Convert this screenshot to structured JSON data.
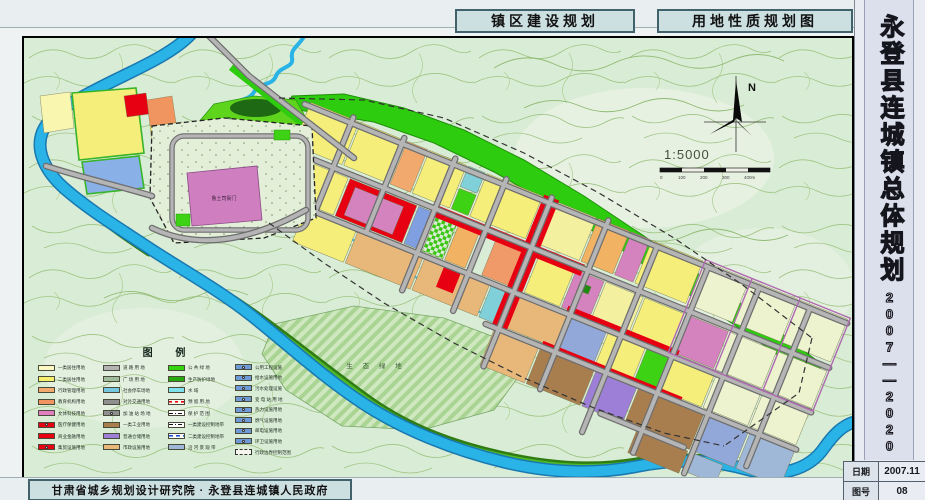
{
  "header": {
    "title_left": "镇区建设规划",
    "title_right": "用地性质规划图"
  },
  "sidebar": {
    "title_vertical": "永登县连城镇总体规划",
    "years_vertical": "2007——2020",
    "info_rows": [
      {
        "label": "日期",
        "value": "2007.11"
      },
      {
        "label": "图号",
        "value": "08"
      }
    ]
  },
  "footer": {
    "credit": "甘肃省城乡规划设计研究院 · 永登县连城镇人民政府"
  },
  "map": {
    "north_label": "N",
    "scale_text": "1:5000",
    "scale_bar_labels": [
      "0",
      "100",
      "200",
      "300",
      "400m"
    ],
    "annotations": {
      "historic_site": "鲁土司衙门",
      "eco_green": "生 态 绿 地"
    },
    "legend": {
      "title": "图    例",
      "columns": [
        [
          {
            "label": "一类居住用地",
            "color": "#fdf9c4",
            "style": "plain"
          },
          {
            "label": "二类居住用地",
            "color": "#f5ee6e",
            "style": "plain"
          },
          {
            "label": "行政管理用地",
            "color": "#f2a96d",
            "style": "plain"
          },
          {
            "label": "教育机构用地",
            "color": "#f0955f",
            "style": "plain"
          },
          {
            "label": "文体科技用地",
            "color": "#e07ec0",
            "style": "plain"
          },
          {
            "label": "医疗保健用地",
            "color": "#e60012",
            "style": "icon"
          },
          {
            "label": "商业金融用地",
            "color": "#e60012",
            "style": "plain"
          },
          {
            "label": "集贸设施用地",
            "color": "#e60012",
            "style": "icon"
          }
        ],
        [
          {
            "label": "道 路 用 地",
            "color": "#b3b3b3",
            "style": "plain"
          },
          {
            "label": "广 场 用 地",
            "color": "#9fbc9a",
            "style": "dots"
          },
          {
            "label": "社会停车场地",
            "color": "#76c8e0",
            "style": "plain"
          },
          {
            "label": "对外交通用地",
            "color": "#8f8f8f",
            "style": "plain"
          },
          {
            "label": "加 油 站 场 地",
            "color": "#8f8f8f",
            "style": "icon"
          },
          {
            "label": "一类工业用地",
            "color": "#a87e4f",
            "style": "plain"
          },
          {
            "label": "普通仓储用地",
            "color": "#9d7fd8",
            "style": "plain"
          },
          {
            "label": "市政设施用地",
            "color": "#e8b87a",
            "style": "plain"
          }
        ],
        [
          {
            "label": "公 共 绿 地",
            "color": "#35d410",
            "style": "plain"
          },
          {
            "label": "生产防护绿地",
            "color": "#27a80d",
            "style": "plain"
          },
          {
            "label": "水    域",
            "color": "#7fe0ee",
            "style": "plain"
          },
          {
            "label": "预 留 用 地",
            "color": "#f7f7e8",
            "style": "dash-red"
          },
          {
            "label": "保 护 范 围",
            "color": "#ffffff",
            "style": "dashdot"
          },
          {
            "label": "一类建设控制地带",
            "color": "#ffffff",
            "style": "dashdot"
          },
          {
            "label": "二类建设控制地带",
            "color": "#ffffff",
            "style": "dash-blue"
          },
          {
            "label": "沿 河 景 观 带",
            "color": "#9fb8d8",
            "style": "hatch"
          }
        ],
        [
          {
            "label": "公用工程设施",
            "color": "#6f9ad8",
            "style": "icon"
          },
          {
            "label": "给水设施用地",
            "color": "#6f9ad8",
            "style": "icon"
          },
          {
            "label": "污水处理设施",
            "color": "#6f9ad8",
            "style": "icon"
          },
          {
            "label": "变 电 站 用 地",
            "color": "#6f9ad8",
            "style": "icon"
          },
          {
            "label": "热力设施用地",
            "color": "#6f9ad8",
            "style": "icon"
          },
          {
            "label": "燃气设施用地",
            "color": "#6f9ad8",
            "style": "icon"
          },
          {
            "label": "邮电设施用地",
            "color": "#6f9ad8",
            "style": "icon"
          },
          {
            "label": "环卫设施用地",
            "color": "#6f9ad8",
            "style": "icon"
          },
          {
            "label": "行政边界控制范围",
            "color": "#f4f6ee",
            "style": "boundary"
          }
        ]
      ]
    }
  },
  "palette": {
    "terrain": "#d9ecd5",
    "contour": "#9cc27f",
    "river": "#29b3e6",
    "road": "#b5b5b5",
    "green_band": "#2ecc0e",
    "residential": "#f5ee7a",
    "commercial_red": "#e60012"
  }
}
